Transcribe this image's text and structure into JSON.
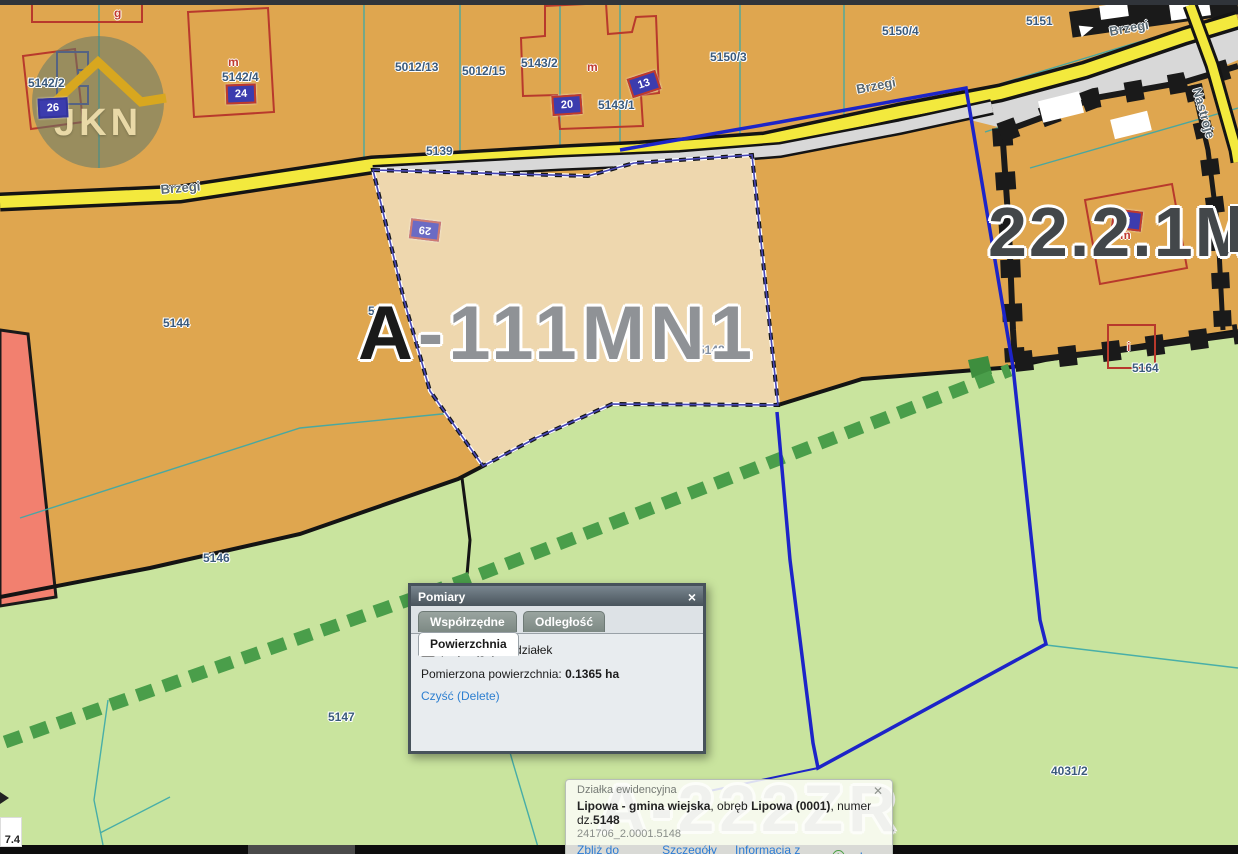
{
  "map": {
    "parcel_labels": [
      "5142/2",
      "5142/4",
      "5012/13",
      "5012/15",
      "5143/2",
      "5143/1",
      "5150/3",
      "5150/4",
      "5151",
      "5139",
      "5144",
      "5145",
      "5146",
      "5147",
      "5148",
      "5164",
      "4031/2"
    ],
    "road_labels": [
      "Brzegi",
      "Brzegi",
      "Brzegi",
      "Nastroje"
    ],
    "zone_labels": [
      "A-111MN1",
      "22.2.1MN",
      "A-222ZR"
    ],
    "building_numbers": [
      "26",
      "24",
      "20",
      "13",
      "29",
      "2"
    ],
    "building_letters": [
      "g",
      "m",
      "m",
      "m",
      "i"
    ],
    "corner_readout": "7.4",
    "watermark_text": "JKN"
  },
  "measure_dialog": {
    "title": "Pomiary",
    "close_label": "×",
    "tabs": [
      "Współrzędne",
      "Odległość",
      "Powierzchnia"
    ],
    "active_tab": "Powierzchnia",
    "checkbox_label": "przyciągaj do działek",
    "measure_label": "Pomierzona powierzchnia:",
    "measure_value": "0.1365 ha",
    "clear_link": "Czyść (Delete)"
  },
  "info_popup": {
    "type_label": "Działka ewidencyjna",
    "close_label": "✕",
    "title_parts": [
      "Lipowa - gmina wiejska",
      ", obręb ",
      "Lipowa (0001)",
      ", numer dz.",
      "5148"
    ],
    "id_text": "241706_2.0001.5148",
    "links": [
      "Zbliż do obiektu",
      "Szczegóły (I)",
      "Informacja z planu",
      "Inne"
    ],
    "plus_icon": "+"
  },
  "colors": {
    "parcel_orange": "#dfa64f",
    "selected_parcel_beige": "#eed7ae",
    "zone_green": "#c9e49e",
    "road_yellow": "#f3e93d",
    "measure_blue": "#1d24c8",
    "boundary_teal": "#3aa8a8",
    "dash_green": "#4a9e4a",
    "parcel_red": "#f2806f",
    "link_blue": "#2b7bd4"
  }
}
